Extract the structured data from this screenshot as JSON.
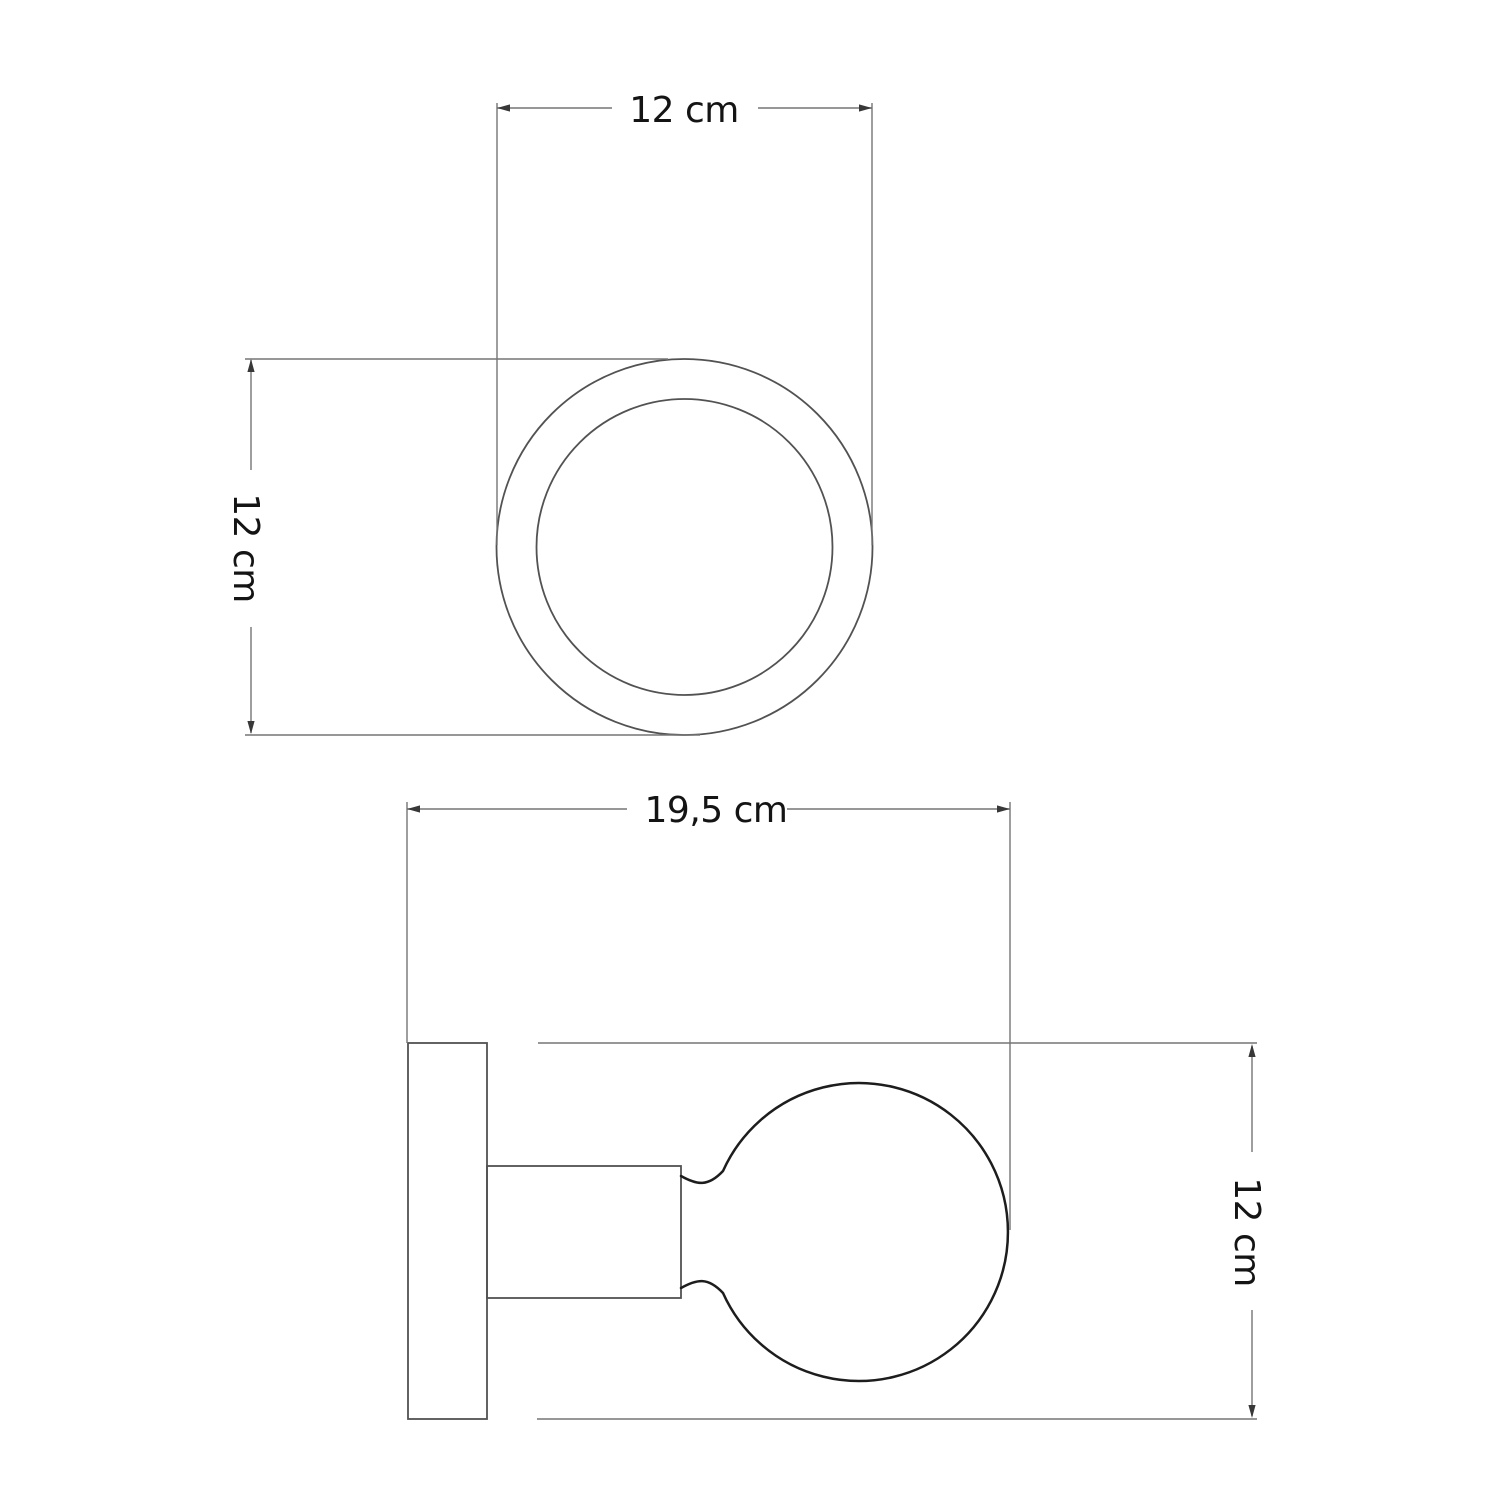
{
  "title": "Wall lamp technical dimension drawing",
  "units": "cm",
  "views": {
    "top": {
      "name": "Top view",
      "width_label": "12 cm",
      "width_cm": 12,
      "height_label": "12 cm",
      "height_cm": 12
    },
    "side": {
      "name": "Side view",
      "depth_label": "19,5 cm",
      "depth_cm": 19.5,
      "height_label": "12 cm",
      "height_cm": 12
    }
  },
  "colors": {
    "background": "#ffffff",
    "shape-stroke": "#525252",
    "bulb-stroke": "#1d1d1d",
    "dim-stroke": "#757575",
    "arrow-fill": "#383838",
    "text-color": "#141414"
  }
}
